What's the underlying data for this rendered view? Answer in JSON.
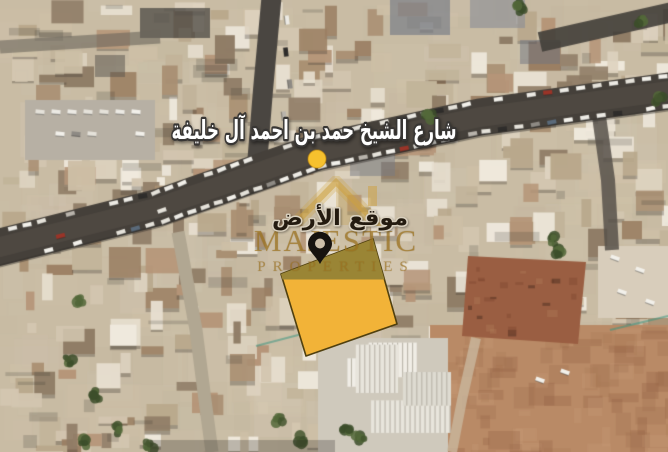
{
  "street_sign": {
    "text": "شارع الشيخ حمد بن احمد آل خليفة",
    "text_color": "#FFFFFF",
    "outline_color": "#383634"
  },
  "plot": {
    "label": "موقع الأرض",
    "label_color": "#241B10",
    "label_outline": "#D9D0BE",
    "points": "373,239 281,274 306,356 397,324",
    "shade_points": "373,239 281,274 282.5,279.5 384.4,279.5",
    "fill": "#F2B338",
    "shade_fill": "#9A8535",
    "border": "#50400F"
  },
  "markers": {
    "street_dot": {
      "cx": "317",
      "cy": "159",
      "r": "9",
      "fill": "#F6C12E",
      "ring": "#C4890A"
    },
    "pin": {
      "fill": "#17130F",
      "hole": "#CDBFA9"
    }
  },
  "watermark": {
    "line1": "MAJESTIC",
    "line2": "PROPERTIES",
    "gold": "#C89B3C"
  }
}
